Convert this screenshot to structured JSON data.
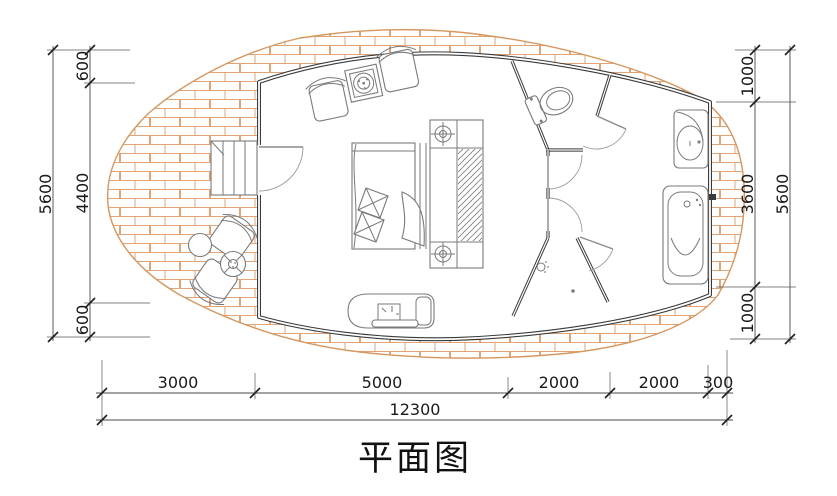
{
  "title": "平面图",
  "dimensions": {
    "left": {
      "overall": "5600",
      "segments": [
        "600",
        "4400",
        "600"
      ]
    },
    "right": {
      "overall": "5600",
      "segments": [
        "1000",
        "3600",
        "1000"
      ]
    },
    "bottom": {
      "overall": "12300",
      "segments": [
        "3000",
        "5000",
        "2000",
        "2000",
        "300"
      ]
    }
  },
  "fixtures": [
    "timber-deck",
    "entry-stairs",
    "entry-door",
    "lounge-chair",
    "plant-side-table",
    "double-bed",
    "bedside-unit",
    "wardrobe",
    "tv-counter",
    "outdoor-chair",
    "outdoor-umbrella-table",
    "outdoor-stool",
    "toilet",
    "shower",
    "wash-basin",
    "bathtub"
  ],
  "colors": {
    "brick": "#e0a477",
    "deck_edge": "#d6975f",
    "wall": "#3a3a3a",
    "furniture": "#7a7a7a",
    "dim_line": "#4a4a4a",
    "text": "#1a1a1a",
    "background": "#ffffff"
  }
}
